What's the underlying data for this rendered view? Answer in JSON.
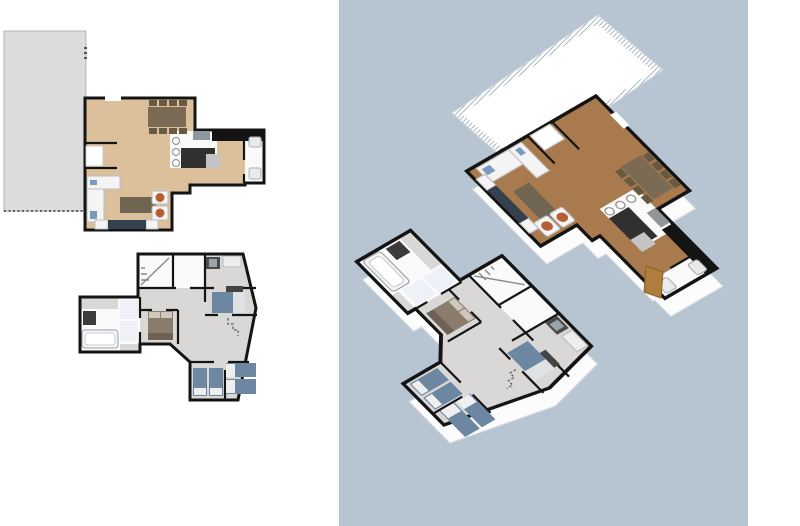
{
  "window": {
    "width": 800,
    "height": 526
  },
  "panels": {
    "plan-2d": {
      "name": "2d-floor-plans",
      "background": "#ffffff",
      "floors": [
        {
          "id": "upper-floor-plan",
          "rooms": [
            "living-room",
            "dining-area",
            "kitchen",
            "bathroom",
            "terrace"
          ]
        },
        {
          "id": "lower-floor-plan",
          "rooms": [
            "stairwell",
            "bathroom",
            "hallway",
            "bedroom-1",
            "bedroom-2",
            "bedroom-3",
            "bedroom-4"
          ]
        }
      ]
    },
    "view-3d": {
      "name": "3d-axonometric-view",
      "background": "#b7c4d1",
      "right-strip": "#ffffff",
      "elements": [
        "terrace-with-railing",
        "upper-floor-model",
        "lower-floor-model"
      ]
    }
  },
  "colors": {
    "page-bg": "#ffffff",
    "viewport-bg": "#b7c4d1",
    "right-strip": "#ffffff",
    "wall": "#141414",
    "floor-wood-2d": "#dcc09b",
    "floor-wood-3d": "#a97a4d",
    "floor-gray": "#dad8d6",
    "terrace": "#dcdcdc",
    "terrace-border": "#b3b3b3",
    "table-brown": "#7b6b54",
    "chair-brown": "#675942",
    "counter-dark": "#303030",
    "counter-step": "#c4c4c4",
    "appliance": "#8f969c",
    "bed-blue": "#6d86a2",
    "bed-brown": "#8b7c6d",
    "bed-footer": "#6e6257",
    "pillow-white": "#efefef",
    "silver": "#dfe2e5",
    "sofa-navy": "#36414f",
    "armchair-rust": "#b65f36",
    "item-blue": "#7a9abd",
    "door-wood": "#b07d3f",
    "stairs-line": "#8a8a8a",
    "railing-line": "#9fadb9"
  }
}
